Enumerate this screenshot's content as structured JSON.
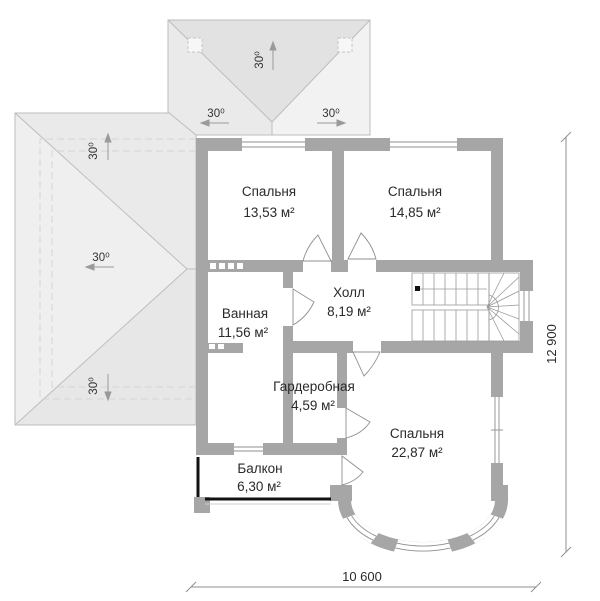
{
  "plan_type": "floor-plan",
  "rooms": [
    {
      "id": "bedroom-1",
      "name": "Спальня",
      "area": "13,53 м²"
    },
    {
      "id": "bedroom-2",
      "name": "Спальня",
      "area": "14,85 м²"
    },
    {
      "id": "bathroom",
      "name": "Ванная",
      "area": "11,56 м²"
    },
    {
      "id": "hall",
      "name": "Холл",
      "area": "8,19 м²"
    },
    {
      "id": "wardrobe",
      "name": "Гардеробная",
      "area": "4,59 м²"
    },
    {
      "id": "bedroom-3",
      "name": "Спальня",
      "area": "22,87 м²"
    },
    {
      "id": "balcony",
      "name": "Балкон",
      "area": "6,30 м²"
    }
  ],
  "dimensions": {
    "width_label": "10 600",
    "height_label": "12 900"
  },
  "roof": {
    "slope_labels": [
      "30⁰",
      "30⁰",
      "30⁰",
      "30⁰",
      "30⁰",
      "30⁰"
    ]
  },
  "colors": {
    "wall": "#a6a6a6",
    "railing": "#121212",
    "line": "#8f8f8f",
    "text": "#2a2a2a",
    "roof_outline": "#bdbdbd",
    "roof_face_dark": "#e2e2e2",
    "roof_face_mid": "#eaeaea",
    "roof_face_light": "#f2f2f2",
    "roof_face_left": "#efefef",
    "roof_face_bottom": "#e7e7e7"
  }
}
